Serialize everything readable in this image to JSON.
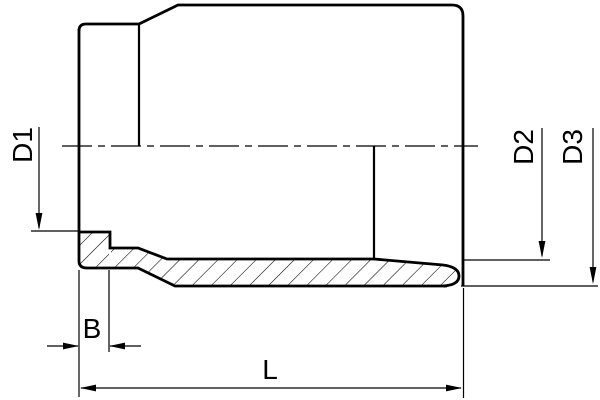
{
  "drawing": {
    "kind": "technical-section-drawing",
    "subject": "pipe-socket-fitting-half-section",
    "background_color": "#ffffff",
    "line_color": "#000000"
  },
  "labels": {
    "d1": "D1",
    "d2": "D2",
    "d3": "D3",
    "b": "B",
    "l": "L"
  },
  "dimensions": [
    {
      "id": "d1",
      "label": "D1",
      "orientation": "rotated-90",
      "position": "left",
      "style": "single-arrow-down-to-bore-line"
    },
    {
      "id": "d2",
      "label": "D2",
      "orientation": "rotated-90",
      "position": "right",
      "style": "single-arrow-down-to-bore-line"
    },
    {
      "id": "d3",
      "label": "D3",
      "orientation": "rotated-90",
      "position": "far-right",
      "style": "single-arrow-down-to-outer-line"
    },
    {
      "id": "b",
      "label": "B",
      "orientation": "horizontal",
      "position": "bottom-left",
      "style": "outside-arrows"
    },
    {
      "id": "l",
      "label": "L",
      "orientation": "horizontal",
      "position": "bottom",
      "style": "inside-arrows-full-length"
    }
  ]
}
